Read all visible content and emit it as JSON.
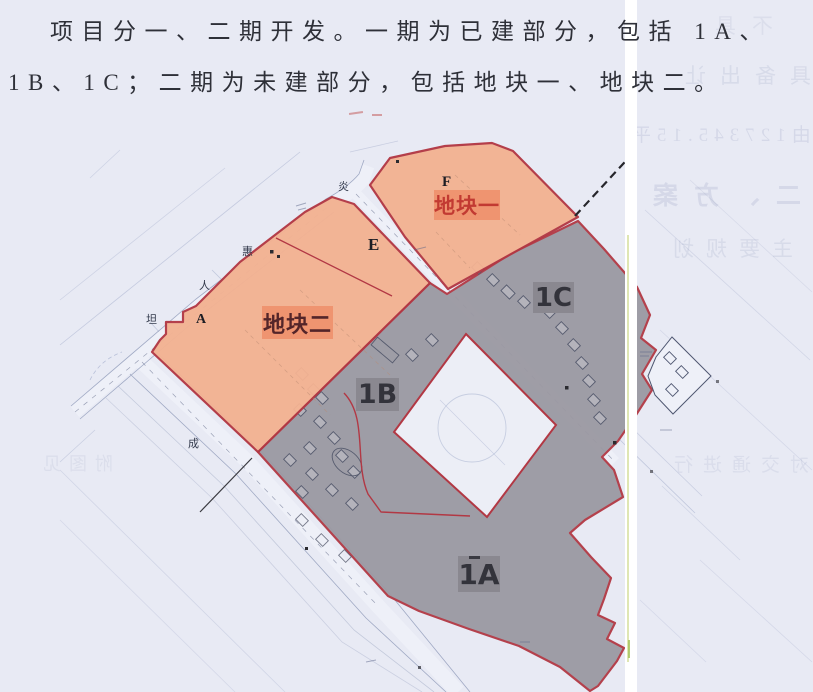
{
  "document": {
    "paragraph": {
      "line1": "项目分一、二期开发。一期为已建部分，包括 1A、",
      "line2": "1B、1C；二期为未建部分，包括地块一、地块二。"
    }
  },
  "map": {
    "plot_labels": {
      "plot1": "地块一",
      "plot2": "地块二",
      "p1a": "1A",
      "p1b": "1B",
      "p1c": "1C",
      "sub_a": "A",
      "sub_e": "E",
      "sub_f": "F"
    },
    "street_labels": [
      {
        "char": "炎"
      },
      {
        "char": "惠"
      },
      {
        "char": "人"
      },
      {
        "char": "坦"
      },
      {
        "char": "成"
      }
    ],
    "colors": {
      "phase2_fill": "#f3b292",
      "phase2_label_bg": "#ef9470",
      "phase1_fill": "#9b99a2",
      "phase1_label_bg": "#8a8890",
      "plot_border": "#b23844",
      "paper": "#e8eaf4"
    }
  },
  "scan_artifacts": {
    "bleedthrough": [
      {
        "text": "不具"
      },
      {
        "text": "具备出让"
      },
      {
        "text": "由127345.15平"
      },
      {
        "text": "二、方案"
      },
      {
        "text": "主要规划"
      },
      {
        "text": "对交通进行"
      },
      {
        "text": "附图见"
      }
    ]
  }
}
